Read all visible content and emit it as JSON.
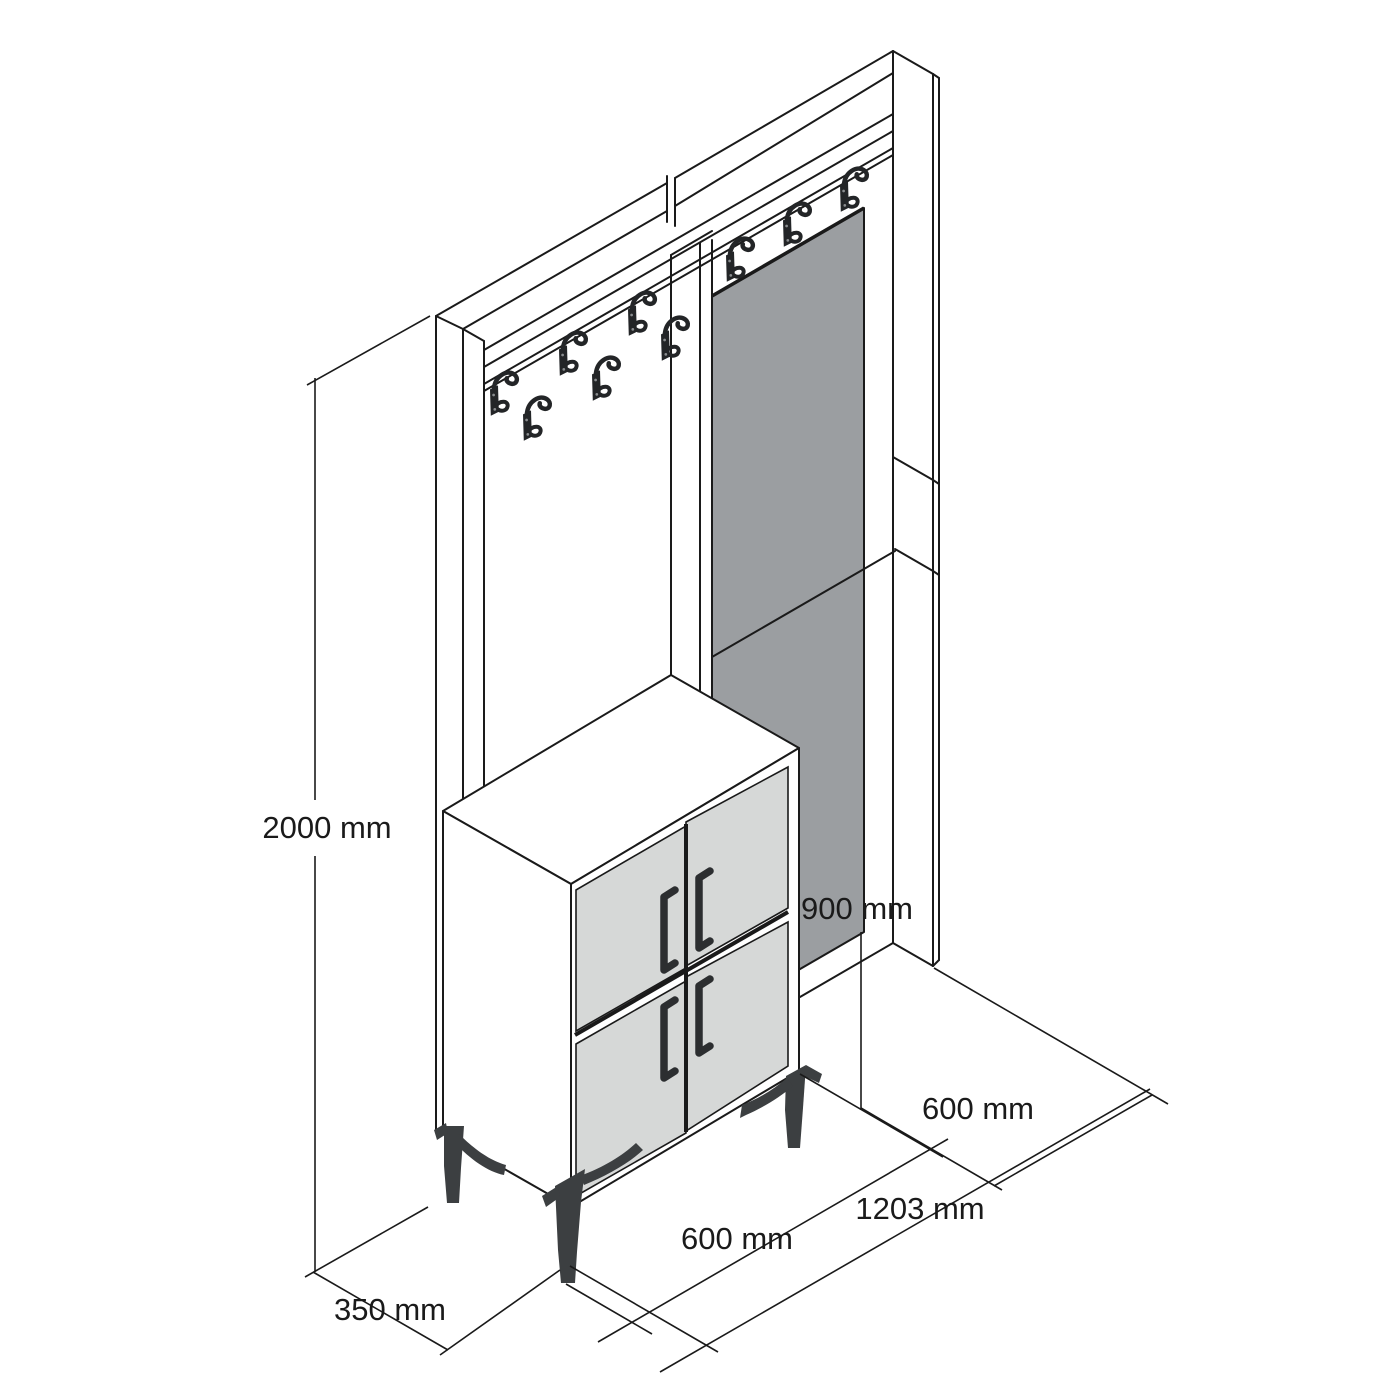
{
  "drawing": {
    "type": "isometric furniture technical drawing",
    "subject": "hallway unit with coat hooks, mirror and four-door shoe cabinet on metal legs",
    "dimensions": {
      "total_height": "2000 mm",
      "base_depth": "350 mm",
      "cabinet_width": "600 mm",
      "total_width": "1203 mm",
      "right_section_width": "600 mm",
      "mirror_bottom_height": "900 mm"
    },
    "counts": {
      "coat_hooks_left_panel": 6,
      "coat_hooks_right_panel": 3,
      "cabinet_doors": 4,
      "door_handles": 4,
      "legs_visible": 3
    },
    "colors": {
      "background": "#ffffff",
      "line": "#1a1a1a",
      "mirror_gray": "#9b9ea1",
      "door_gray": "#d6d8d7",
      "handle_dark": "#2c2e30",
      "hook_dark": "#232527",
      "leg_dark": "#3c3f41"
    }
  }
}
